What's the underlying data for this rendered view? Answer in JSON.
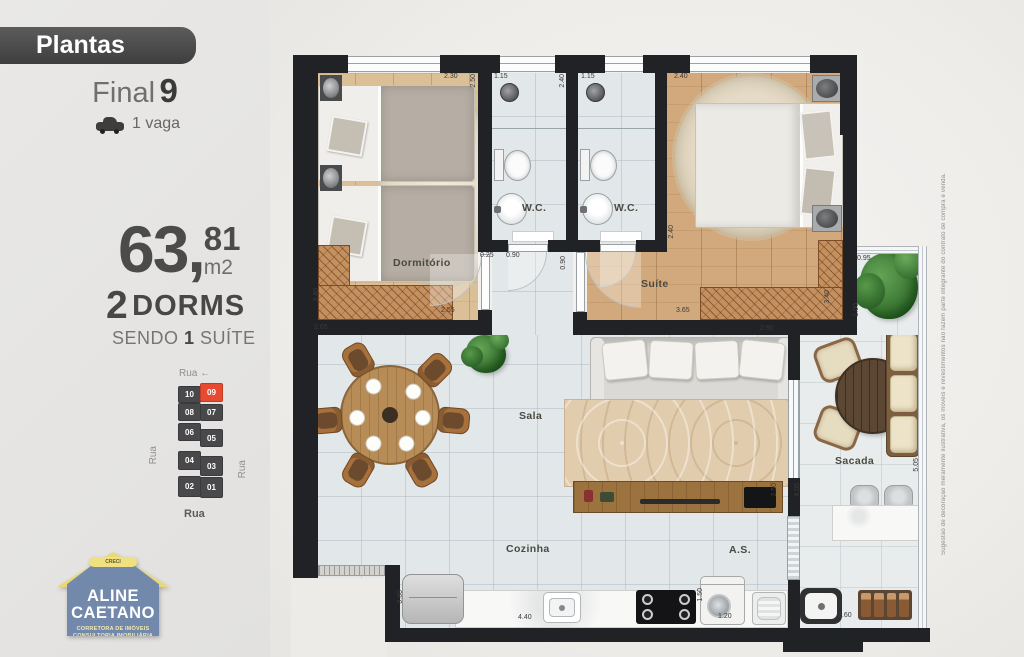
{
  "sidebar": {
    "plantas_label": "Plantas",
    "final_label": "Final",
    "final_number": "9",
    "vaga_label": "1 vaga",
    "area_main": "63,",
    "area_sup": "81",
    "area_unit": "m2",
    "dorms_number": "2",
    "dorms_label": "DORMS",
    "sendo_pre": "SENDO ",
    "sendo_num": "1",
    "sendo_post": " SUÍTE",
    "building": {
      "rua_top": "Rua ←",
      "rua_left": "Rua",
      "rua_right": "Rua",
      "rua_bottom": "Rua",
      "units": [
        "10",
        "09",
        "08",
        "07",
        "06",
        "05",
        "04",
        "03",
        "02",
        "01"
      ],
      "highlighted_unit": "09"
    },
    "logo": {
      "creci": "CRECI",
      "name_line1": "ALINE",
      "name_line2": "CAETANO",
      "tag_line1": "CORRETORA DE IMÓVEIS",
      "tag_line2": "CONSULTORIA IMOBILIÁRIA"
    }
  },
  "plan": {
    "rooms": {
      "dormitorio": "Dormitório",
      "wc1": "W.C.",
      "wc2": "W.C.",
      "suite": "Suíte",
      "sala": "Sala",
      "sacada": "Sacada",
      "cozinha": "Cozinha",
      "as": "A.S."
    },
    "dims": [
      "2.30",
      "2.50",
      "1.15",
      "2.40",
      "1.15",
      "2.40",
      "0.25",
      "0.90",
      "0.90",
      "3.40",
      "2.55",
      "2.65",
      "2.40",
      "3.65",
      "3.40",
      "0.95",
      "1.00",
      "2.90",
      "2.50",
      "4.05",
      "5.05",
      "0.60",
      "4.40",
      "1.50",
      "1.20",
      "1.60"
    ],
    "disclaimer": "Sugestão de decoração meramente ilustrativa, os móveis e revestimentos não fazem parte integrante do contrato de compra e venda."
  },
  "colors": {
    "highlight_unit": "#e64a31",
    "wall": "#212225",
    "wood_floor": "#dabf97",
    "wood_floor_suite": "#d2a97c",
    "tile_floor": "#e2e7e9",
    "badge_bg": "#4a4a4a",
    "logo_roof": "#e9d873",
    "logo_body": "#7289ac"
  }
}
